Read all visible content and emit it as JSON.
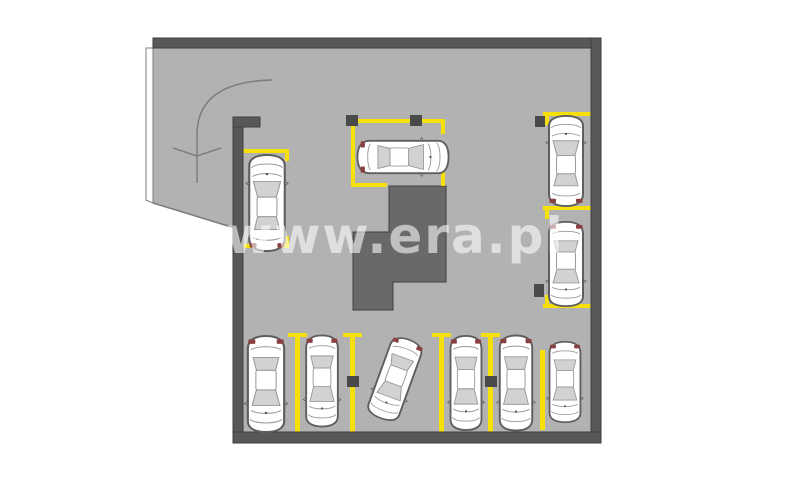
{
  "watermark": {
    "text": "www.era.pl",
    "x": 226,
    "y": 211,
    "font_size": 50,
    "letter_spacing": 2
  },
  "colors": {
    "background": "#ffffff",
    "floor": "#b2b2b2",
    "wall": "#585858",
    "wall_edge": "#3f3f3f",
    "stairwell": "#696969",
    "yellow": "#f5e00a",
    "column": "#4a4a4a",
    "ramp_line": "#7d7d7d",
    "ramp_edge_fill": "#ffffff",
    "car_body": "#ffffff",
    "car_outline": "#5e5e5e",
    "car_window": "#d2d2d2",
    "car_detail": "#9a9a9a",
    "car_taillight": "#8a4040",
    "watermark": "rgba(255,255,255,0.58)"
  },
  "floorplan": {
    "canvas": {
      "width": 800,
      "height": 486
    },
    "floor": {
      "x": 236,
      "y": 43,
      "w": 360,
      "h": 394
    },
    "ramp": {
      "surface_points": "153,43 238,43 238,230 153,203",
      "edge_strip_points": "146,48 153,48 153,203 146,200",
      "slant_line": {
        "x1": 153,
        "y1": 203,
        "x2": 238,
        "y2": 229
      },
      "drive_path_d": "M 272 80 C 230 81 198 94 197 133 L 197 183",
      "arrow_points": "173,148 197,156 221,148"
    },
    "stairwell_points": "389,186 446,186 446,282 393,282 393,310 353,310 353,232 389,232",
    "walls": [
      {
        "name": "wall-top",
        "x": 153,
        "y": 38,
        "w": 448,
        "h": 10
      },
      {
        "name": "wall-right",
        "x": 591,
        "y": 38,
        "w": 10,
        "h": 405
      },
      {
        "name": "wall-bottom",
        "x": 233,
        "y": 432,
        "w": 368,
        "h": 11
      },
      {
        "name": "wall-left",
        "x": 233,
        "y": 117,
        "w": 10,
        "h": 315
      },
      {
        "name": "wall-left-stub",
        "x": 233,
        "y": 117,
        "w": 27,
        "h": 10
      }
    ],
    "parking_lines": [
      {
        "name": "spot-left-top-bar",
        "x": 243,
        "y": 149,
        "w": 46,
        "h": 4
      },
      {
        "name": "spot-left-top-tick",
        "x": 285,
        "y": 153,
        "w": 4,
        "h": 8
      },
      {
        "name": "spot-left-bottom-bar",
        "x": 243,
        "y": 244,
        "w": 46,
        "h": 4
      },
      {
        "name": "spot-left-bottom-tick",
        "x": 285,
        "y": 236,
        "w": 4,
        "h": 8
      },
      {
        "name": "spot-mid-top-bar",
        "x": 351,
        "y": 119,
        "w": 94,
        "h": 4
      },
      {
        "name": "spot-mid-left-bar",
        "x": 351,
        "y": 123,
        "w": 4,
        "h": 64
      },
      {
        "name": "spot-mid-bottom-left-bar",
        "x": 355,
        "y": 183,
        "w": 32,
        "h": 4
      },
      {
        "name": "spot-mid-right-tick-top",
        "x": 441,
        "y": 123,
        "w": 4,
        "h": 11
      },
      {
        "name": "spot-mid-right-tick-bot",
        "x": 441,
        "y": 172,
        "w": 4,
        "h": 14
      },
      {
        "name": "spot-right-top-bar",
        "x": 543,
        "y": 112,
        "w": 49,
        "h": 4
      },
      {
        "name": "spot-right-top-tick",
        "x": 545,
        "y": 116,
        "w": 4,
        "h": 9
      },
      {
        "name": "spot-right-mid-bar",
        "x": 543,
        "y": 206,
        "w": 48,
        "h": 4
      },
      {
        "name": "spot-right-mid-tick",
        "x": 545,
        "y": 210,
        "w": 4,
        "h": 9
      },
      {
        "name": "spot-right-bottom-bar",
        "x": 543,
        "y": 304,
        "w": 49,
        "h": 4
      },
      {
        "name": "spot-right-bottom-tick",
        "x": 545,
        "y": 295,
        "w": 4,
        "h": 9
      },
      {
        "name": "bottom-line-1-bar",
        "x": 288,
        "y": 333,
        "w": 19,
        "h": 4
      },
      {
        "name": "bottom-line-1-stem",
        "x": 295,
        "y": 337,
        "w": 5,
        "h": 95
      },
      {
        "name": "bottom-line-2-bar",
        "x": 343,
        "y": 333,
        "w": 19,
        "h": 4
      },
      {
        "name": "bottom-line-2-stem",
        "x": 350,
        "y": 337,
        "w": 5,
        "h": 95
      },
      {
        "name": "bottom-line-3-bar",
        "x": 432,
        "y": 333,
        "w": 19,
        "h": 4
      },
      {
        "name": "bottom-line-3-stem",
        "x": 439,
        "y": 337,
        "w": 5,
        "h": 95
      },
      {
        "name": "bottom-line-4-bar",
        "x": 481,
        "y": 333,
        "w": 19,
        "h": 4
      },
      {
        "name": "bottom-line-4-stem",
        "x": 488,
        "y": 337,
        "w": 5,
        "h": 95
      },
      {
        "name": "bottom-line-5-stem",
        "x": 540,
        "y": 350,
        "w": 5,
        "h": 80
      }
    ],
    "columns": [
      {
        "name": "column",
        "x": 346,
        "y": 115,
        "w": 12,
        "h": 11
      },
      {
        "name": "column",
        "x": 410,
        "y": 115,
        "w": 12,
        "h": 11
      },
      {
        "name": "column",
        "x": 535,
        "y": 116,
        "w": 10,
        "h": 11
      },
      {
        "name": "column",
        "x": 534,
        "y": 284,
        "w": 10,
        "h": 13
      },
      {
        "name": "column",
        "x": 347,
        "y": 376,
        "w": 12,
        "h": 11
      },
      {
        "name": "column",
        "x": 485,
        "y": 376,
        "w": 12,
        "h": 11
      }
    ],
    "cars": [
      {
        "name": "car-left",
        "x": 267,
        "y": 203,
        "angle": 0,
        "w": 46,
        "len": 98
      },
      {
        "name": "car-top-middle",
        "x": 403,
        "y": 157,
        "angle": 90,
        "w": 42,
        "len": 93
      },
      {
        "name": "car-right-upper",
        "x": 566,
        "y": 161,
        "angle": 0,
        "w": 44,
        "len": 92
      },
      {
        "name": "car-right-lower",
        "x": 566,
        "y": 264,
        "angle": 180,
        "w": 44,
        "len": 86
      },
      {
        "name": "car-bottom-1",
        "x": 266,
        "y": 384,
        "angle": 180,
        "w": 47,
        "len": 98
      },
      {
        "name": "car-bottom-2",
        "x": 322,
        "y": 381,
        "angle": 180,
        "w": 41,
        "len": 93
      },
      {
        "name": "car-bottom-3-tilted",
        "x": 395,
        "y": 379,
        "angle": 200,
        "w": 42,
        "len": 85
      },
      {
        "name": "car-bottom-4",
        "x": 466,
        "y": 383,
        "angle": 180,
        "w": 40,
        "len": 96
      },
      {
        "name": "car-bottom-5",
        "x": 516,
        "y": 383,
        "angle": 180,
        "w": 42,
        "len": 97
      },
      {
        "name": "car-bottom-6",
        "x": 565,
        "y": 382,
        "angle": 180,
        "w": 40,
        "len": 82
      }
    ]
  }
}
